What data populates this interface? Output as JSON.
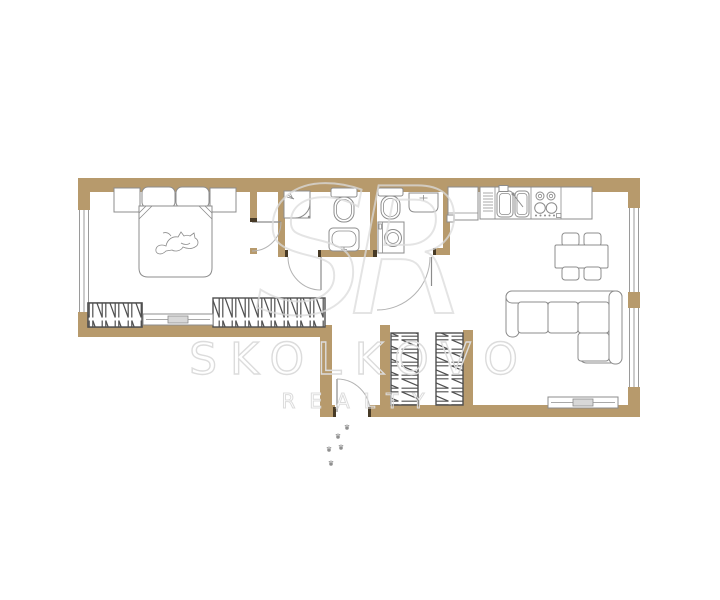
{
  "watermark": {
    "brand": "SKOLKOVO",
    "subtitle": "REALTY",
    "monogram": "SR"
  },
  "colors": {
    "wall": "#b79a6c",
    "furniture-line": "#8c8c8c",
    "window-line": "#9a9a9a",
    "hatch": "#4f4f4f",
    "watermark": "#dcdcdc",
    "paw": "#8f8f8f",
    "door-arc": "#b3b3b3",
    "radiator-fill": "#d8d8d8",
    "stop": "#473a26"
  },
  "plan": {
    "type": "apartment-floor-plan",
    "rooms": [
      "bedroom",
      "bathroom",
      "toilet",
      "hallway",
      "entrance-vestibule",
      "closet",
      "kitchen-living-room"
    ],
    "elements": [
      "double-bed",
      "pillows",
      "nightstand-left",
      "nightstand-right",
      "cat-illustration",
      "wardrobe-bedroom-left",
      "wardrobe-bedroom-long",
      "radiator-bedroom",
      "shower-cabin",
      "toilet-1",
      "washbasin-1",
      "toilet-2",
      "washbasin-2",
      "washing-machine",
      "refrigerator",
      "kitchen-counter",
      "dish-rack",
      "double-kitchen-sink",
      "cooktop-4-burners",
      "dining-table",
      "dining-chairs-4",
      "corner-sofa",
      "radiator-living",
      "closet-wardrobe-1",
      "closet-wardrobe-2",
      "window-left",
      "window-right-1",
      "window-right-2",
      "door-bedroom",
      "door-bathroom-1",
      "door-bathroom-2",
      "door-hall-living",
      "entrance-door",
      "cat-paw-prints"
    ]
  }
}
